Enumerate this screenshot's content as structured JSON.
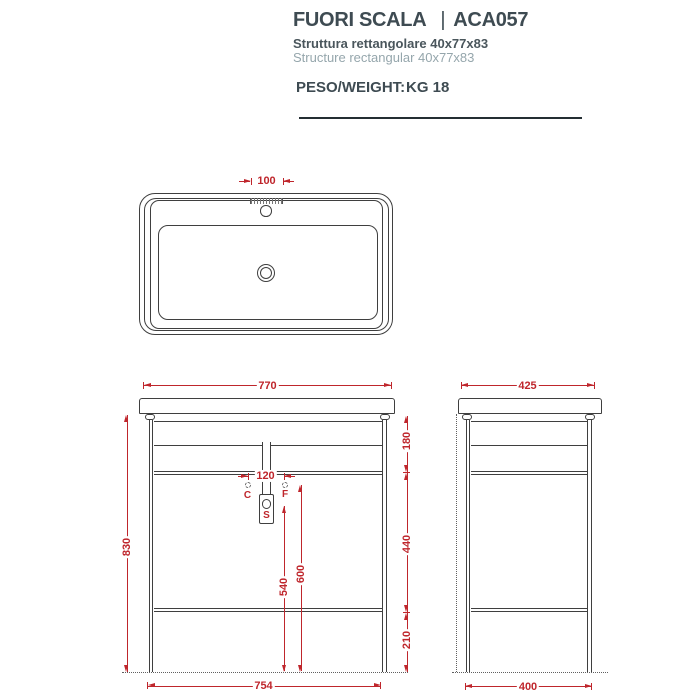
{
  "header": {
    "title": "FUORI SCALA",
    "divider": "|",
    "code": "ACA057",
    "subtitle_it": "Struttura rettangolare 40x77x83",
    "subtitle_en": "Structure rectangular 40x77x83",
    "weight_label": "PESO/WEIGHT:",
    "weight_value": "KG 18"
  },
  "top_view": {
    "tap_platform_width": "100"
  },
  "front_view": {
    "width_top": "770",
    "width_bottom": "754",
    "height_total": "830",
    "basin_to_rail": "180",
    "rail_to_shelf": "440",
    "shelf_to_floor": "210",
    "connection_spacing": "120",
    "connection_height": "600",
    "siphon_height": "540",
    "label_c": "C",
    "label_f": "F",
    "label_s": "S"
  },
  "side_view": {
    "depth_top": "425",
    "depth_bottom": "400"
  },
  "colors": {
    "dimension_red": "#bf262c",
    "line_gray": "#3f3f3f",
    "title_dark": "#3e4b52",
    "subtitle_light": "#95a6ac"
  }
}
